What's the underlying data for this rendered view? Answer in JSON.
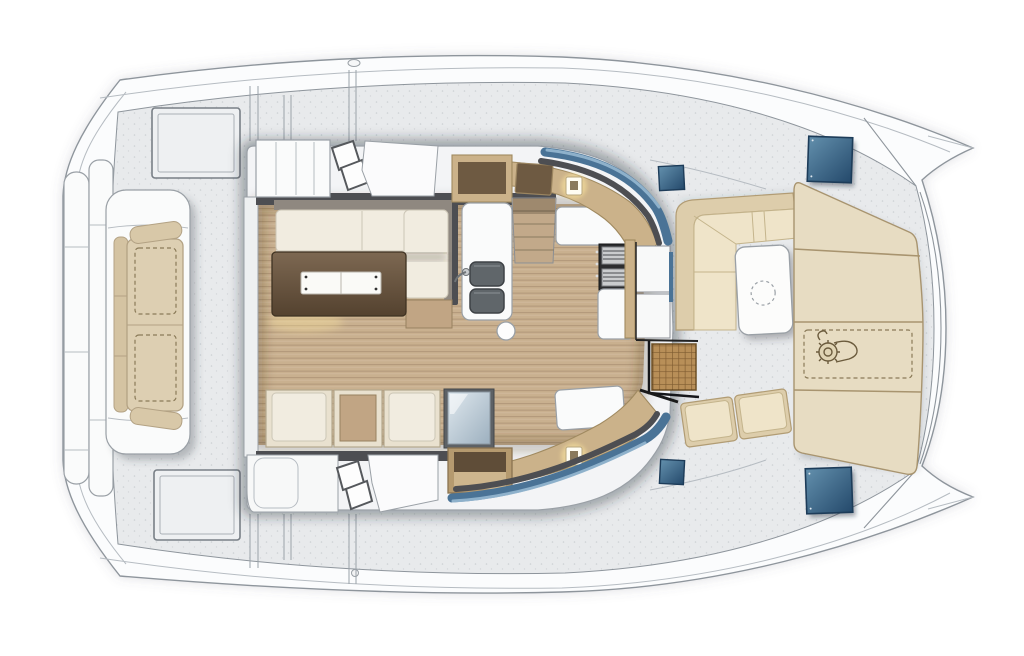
{
  "page": {
    "kind": "boat-deck-floor-plan",
    "description": "Top-down interior layout plan of a sailing catamaran main deck; no text labels are rendered in the drawing",
    "visible_text": []
  },
  "palette": {
    "canvas_bg": "#ffffff",
    "hull_fill": "#fbfcfd",
    "hull_line": "#8e959c",
    "deck_fill": "#e8eaec",
    "roof_fill": "#f3f4f6",
    "dark_frame": "#4d4e52",
    "wood_floor": "#c9b08f",
    "wood_table_light": "#7d6852",
    "wood_table_dark": "#54422f",
    "table_leaf": "#fafaf7",
    "cushion_cream": "#f1ece0",
    "cushion_tan": "#c1a584",
    "pad_beige": "#e7dcc2",
    "pad_line": "#a8946f",
    "dash_beige": "#cbb28a",
    "recess_brown": "#6e5a42",
    "glass_blue": "#4a7396",
    "glass_blue_light": "#9fc0d8",
    "hatch_blue_dark": "#24496b",
    "hatch_blue_light": "#6390ad",
    "teak": "#b88f58",
    "teak_line": "#6e5127",
    "stove_dark": "#2c2d2f",
    "steel": "#caccce",
    "sink_gray": "#60666a",
    "light_glow": "#ffe9a0",
    "fridge_glass_light": "#dfe8ee",
    "fridge_glass_dark": "#9db0bf"
  },
  "regions": [
    "swim-platform",
    "aft-bench",
    "side-decks",
    "saloon",
    "saloon-sofa",
    "saloon-table",
    "aft-seat-row",
    "galley",
    "galley-sink",
    "galley-stove",
    "companionway-steps",
    "entry-door",
    "teak-grate-doormat",
    "forward-cockpit",
    "forward-cockpit-table",
    "forward-sunpad",
    "windlass-zone",
    "deck-hatches",
    "port-bow",
    "starboard-bow"
  ],
  "icons": [
    "windlass-icon",
    "table-circle-mark",
    "courtesy-light-icon",
    "deck-hatch-glass",
    "sink-bowls",
    "stove-grates"
  ]
}
